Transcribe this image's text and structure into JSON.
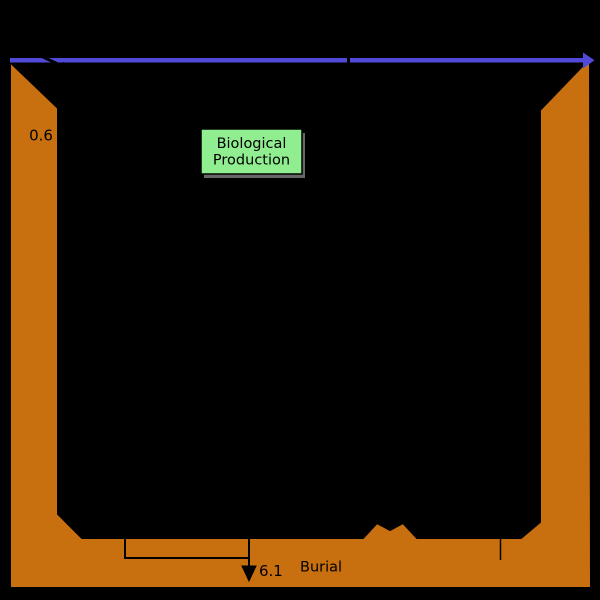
{
  "diagram": {
    "type": "ocean-sediment-cycle-diagram",
    "background_color": "#000000",
    "colors": {
      "sediment": "#c8700f",
      "surface_arrow": "#514ad9",
      "box_fill": "#90ee90",
      "box_border": "#000000",
      "box_shadow": "#666666",
      "line": "#000000"
    },
    "labels": {
      "shelf_flux": "0.6",
      "burial_flux": "6.1",
      "burial": "Burial",
      "biological_production_line1": "Biological",
      "biological_production_line2": "Production"
    }
  }
}
